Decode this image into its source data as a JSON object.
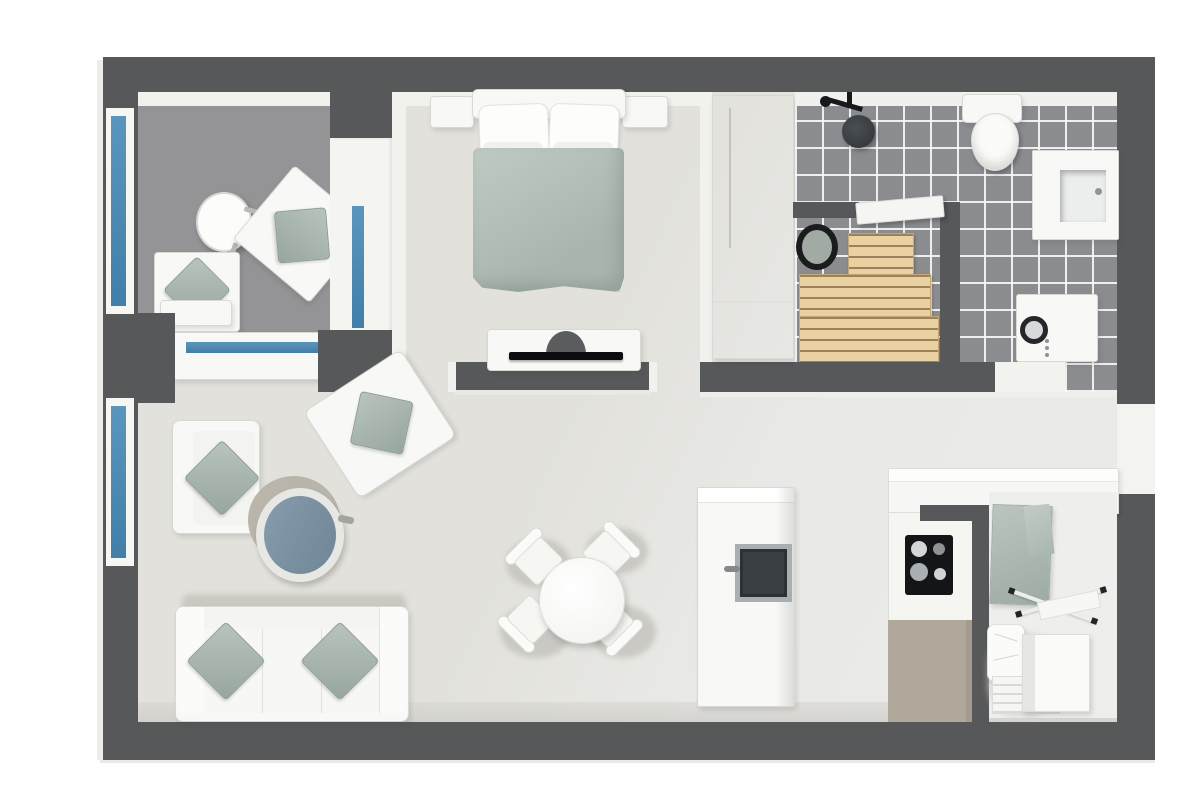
{
  "meta": {
    "title": "3D apartment floor plan",
    "view": "top-down 3D render, no text labels",
    "style": "white furniture with sage green accents, dark grey walls, blue window glazing"
  },
  "palette": {
    "wall_dark_grey": "#57585a",
    "floor_main_beige": "#e2e1db",
    "floor_main_light": "#eaeaea",
    "floor_balcony_grey": "#949497",
    "bathroom_tile_grey": "#8a8c8f",
    "tile_grout_white": "#ffffff",
    "furniture_white": "#f8f8f6",
    "accent_sage_green": "#aebcb5",
    "window_glass_blue": "#4a89b4",
    "sauna_wood": "#ead1a2",
    "coffee_table_blue": "#7b93a5",
    "kitchen_cabinet_greige": "#b1a89c",
    "appliance_black": "#141517"
  },
  "rooms": {
    "balcony": {
      "label": "Glazed balcony",
      "items": [
        "round side table",
        "angled lounge chair with sage cushion",
        "lounge chair with sage cushion and footstool",
        "full-height glazing",
        "low window wall"
      ]
    },
    "bedroom": {
      "label": "Bedroom",
      "items": [
        "double bed with sage duvet",
        "white headboard",
        "4 white pillows",
        "left nightstand",
        "right nightstand",
        "TV cabinet on half wall",
        "flat TV"
      ]
    },
    "wardrobe_nook": {
      "label": "Wardrobe nook",
      "items": [
        "tall white wardrobe"
      ]
    },
    "bathroom": {
      "label": "Bathroom",
      "items": [
        "rain shower",
        "toilet",
        "vanity with square basin",
        "washing machine",
        "grey floor tiles"
      ]
    },
    "sauna": {
      "label": "Sauna",
      "items": [
        "round sauna heater",
        "tiered wooden benches",
        "white door"
      ]
    },
    "living_room": {
      "label": "Living room",
      "items": [
        "three-seat sofa with two sage cushions",
        "armchair by window",
        "angled armchair",
        "round tan rug",
        "round blue coffee table"
      ]
    },
    "dining_area": {
      "label": "Dining area",
      "items": [
        "round white dining table",
        "four white chairs"
      ]
    },
    "fireplace_unit": {
      "label": "Tall unit with dark glass door",
      "items": [
        "glass door with handle"
      ]
    },
    "kitchen": {
      "label": "Kitchen",
      "items": [
        "black cooktop with 4 burners",
        "white counter run",
        "greige base cabinet",
        "partition wall"
      ]
    },
    "utility_room": {
      "label": "Utility room",
      "items": [
        "sage stone counter",
        "white sink box",
        "folding drying rack",
        "white pillow",
        "slatted bench"
      ]
    },
    "entry": {
      "label": "Entry doorway in right wall"
    }
  },
  "windows": {
    "count": 4,
    "glass_color": "#4a89b4",
    "positions": [
      "balcony left wall",
      "living room left wall",
      "balcony partition",
      "balcony low wall"
    ]
  }
}
